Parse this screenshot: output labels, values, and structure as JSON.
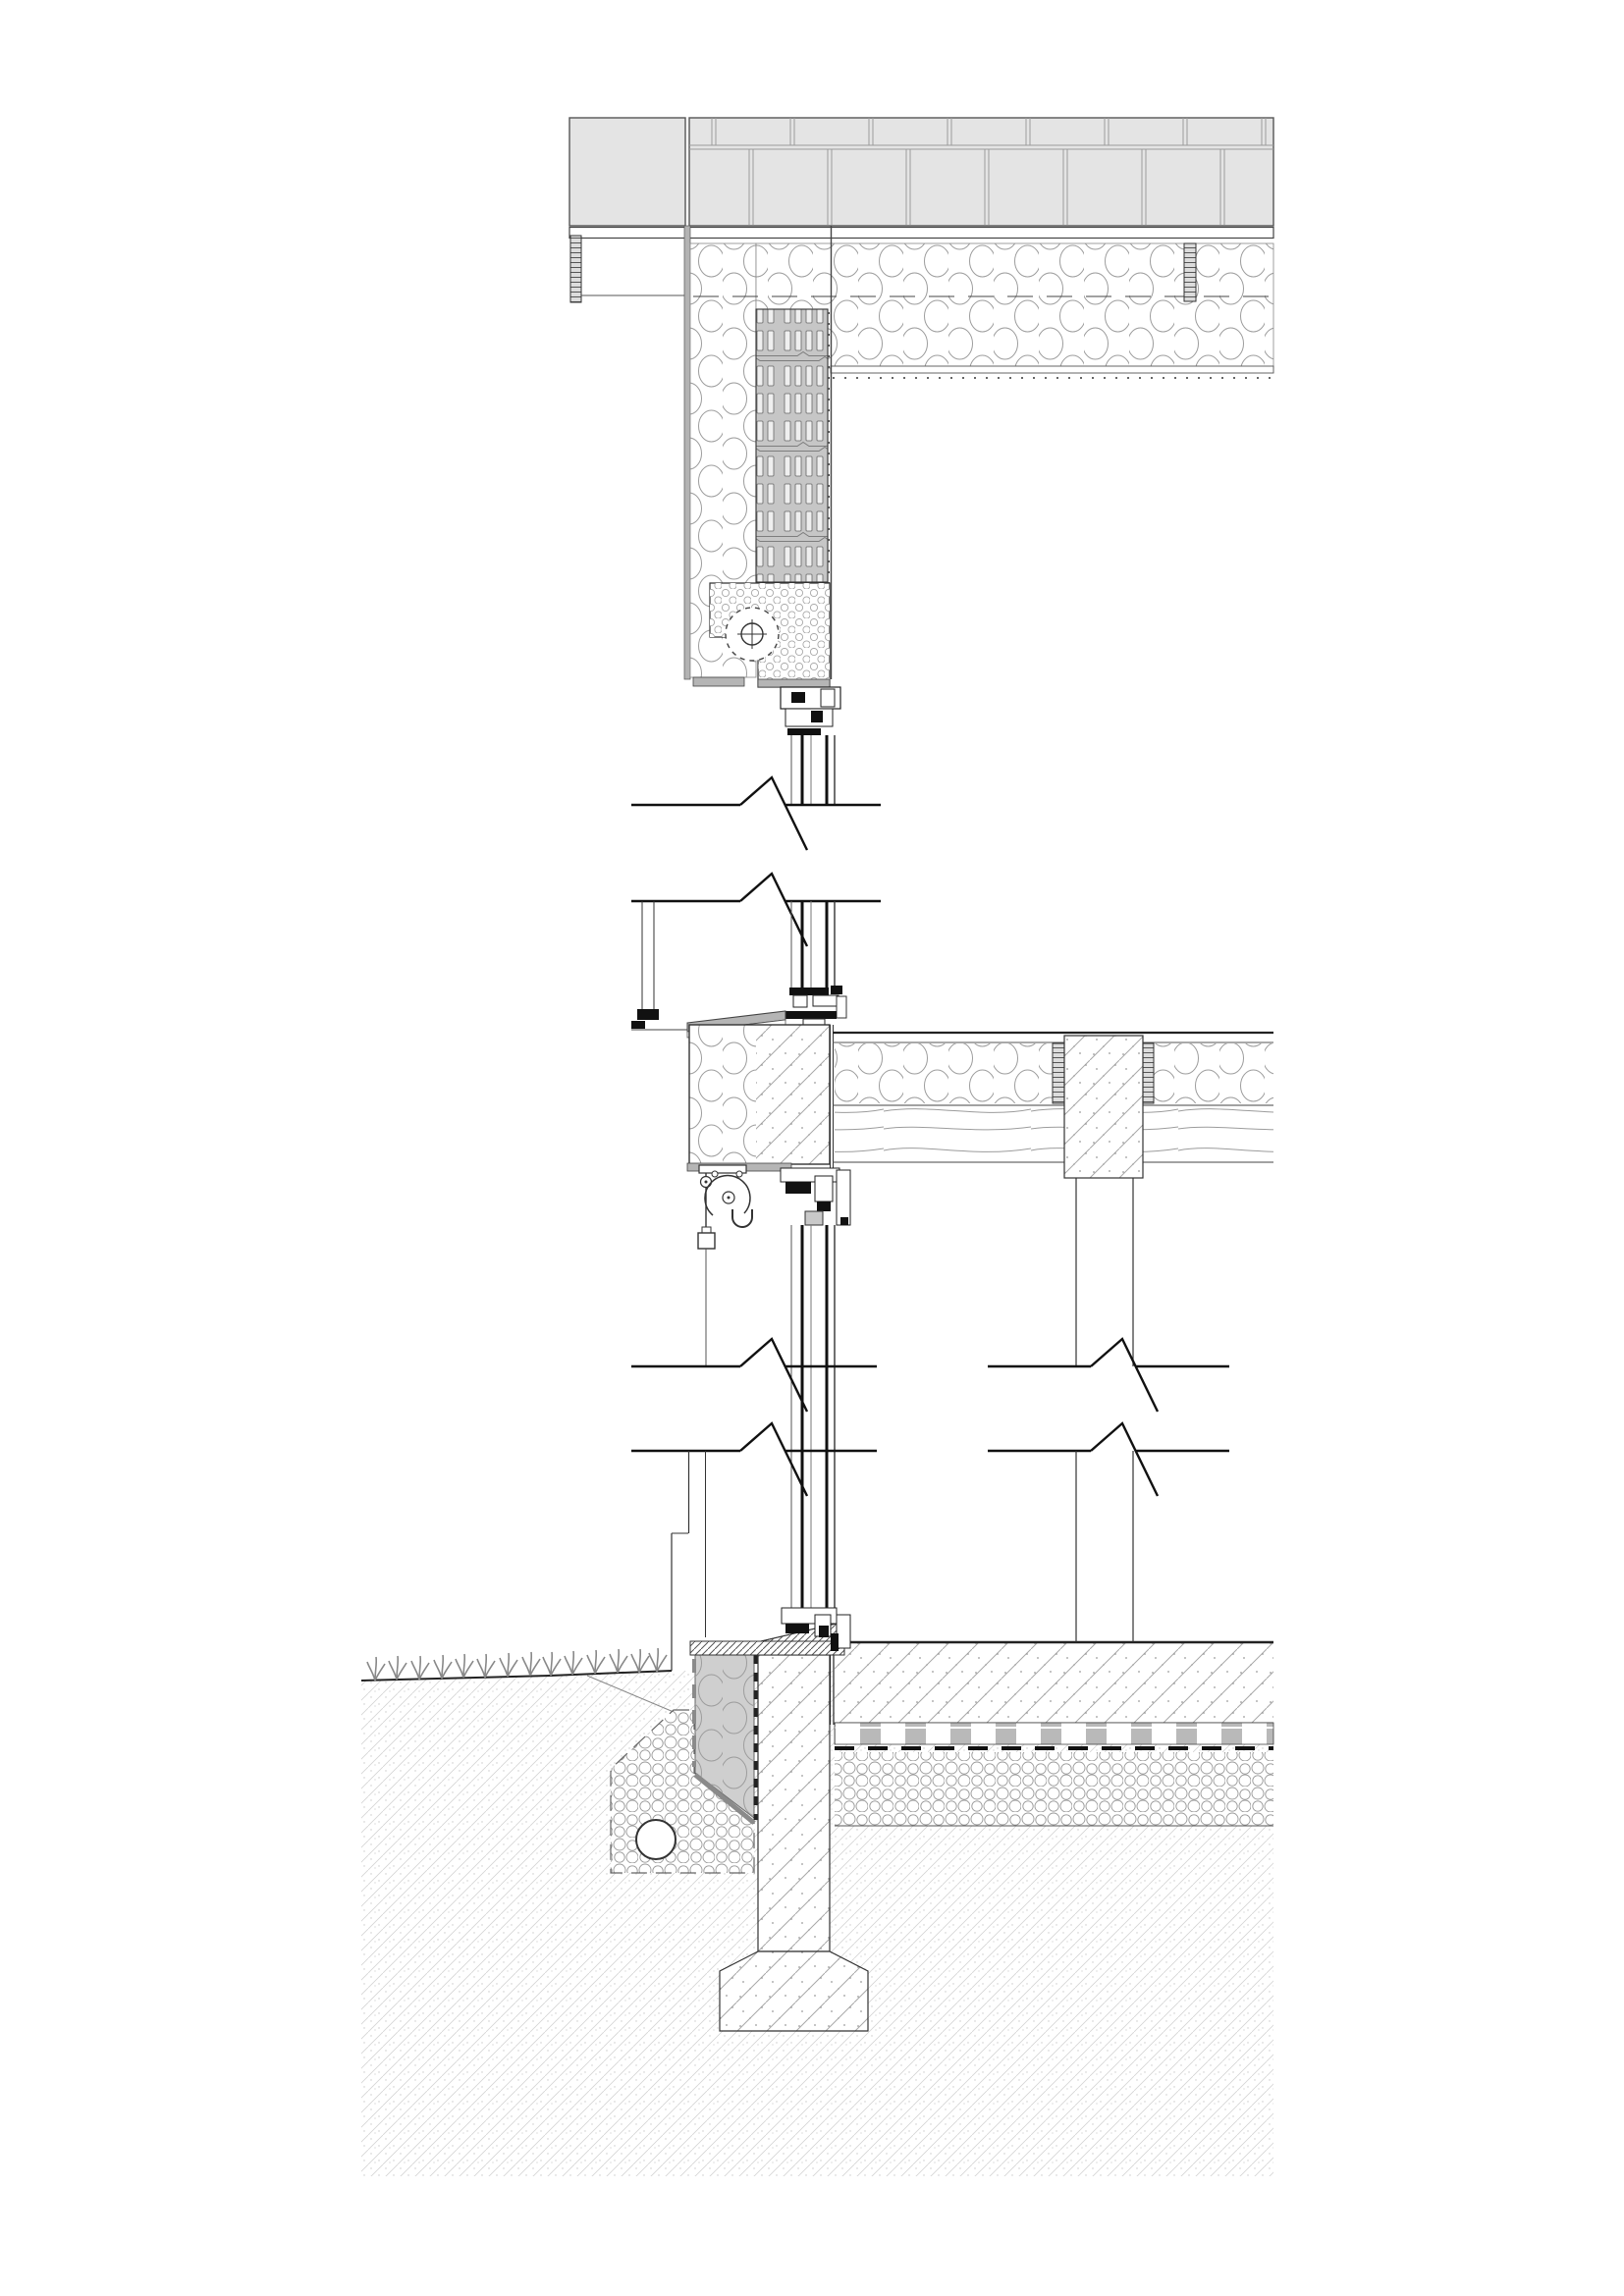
{
  "document": {
    "type": "architectural construction section details",
    "sheet_color": "#ffffff",
    "line_color": "#3a3a3a",
    "details_count": 3
  },
  "palette": {
    "slab_gray": "#e4e4e4",
    "joint_gray": "#9b9b9b",
    "plaster_gray": "#b3b3b3",
    "brick_gray": "#c6c6c6",
    "insulation_stroke": "#9c9c9c",
    "plinth_insulation_gray": "#cfcfcf",
    "hardware_black": "#111111",
    "concrete_stroke": "#a8a8a8",
    "soil_stroke": "#d4d4d4",
    "metal_plate_gray": "#b5b5b5"
  },
  "details": [
    {
      "id": "roof-ceiling-junction",
      "aria": "Detail 1: roof slab, ceiling insulation, perforated brick wall head, roller shutter box and window head",
      "materials": [
        "paver slab",
        "deck board",
        "batt insulation",
        "perforated brick",
        "shutter box insulation",
        "window frame"
      ]
    },
    {
      "id": "floor-edge-junction",
      "aria": "Detail 2: window sill and head at intermediate floor edge, insulated edge beam, timber floor with concrete pier, awning pulley",
      "materials": [
        "window sill",
        "edge beam concrete",
        "batt insulation",
        "timber planking",
        "concrete pier",
        "awning bracket"
      ]
    },
    {
      "id": "foundation-plinth-junction",
      "aria": "Detail 3: ground floor slab, plinth insulation, strip footing, drainage gravel with pipe, grass and soil",
      "materials": [
        "window sill board",
        "perimeter insulation",
        "concrete plinth and footing",
        "drain pipe",
        "gravel",
        "underslab insulation",
        "soil"
      ]
    }
  ]
}
